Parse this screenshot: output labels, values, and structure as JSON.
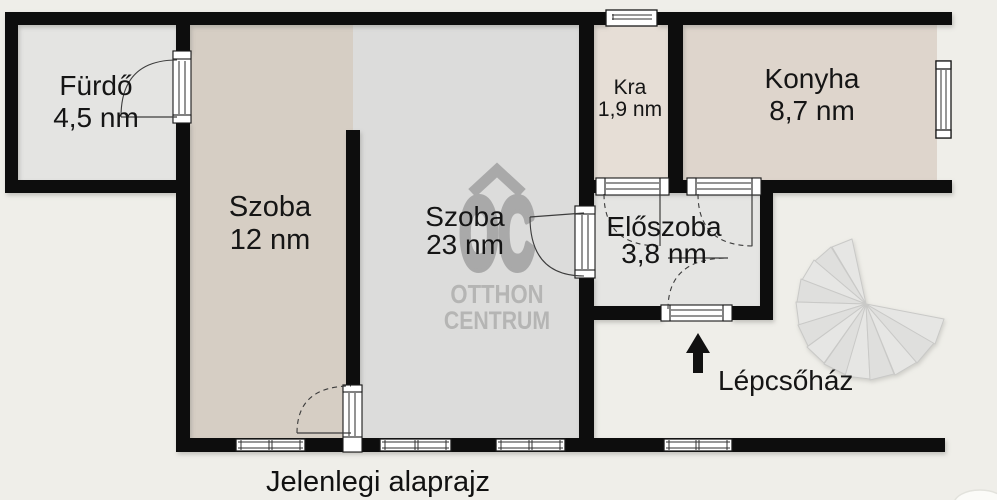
{
  "caption": "Jelenlegi alaprajz",
  "rooms": {
    "furdo": {
      "label": "Fürdő",
      "area": "4,5 nm"
    },
    "szoba12": {
      "label": "Szoba",
      "area": "12 nm"
    },
    "szoba23": {
      "label": "Szoba",
      "area": "23 nm"
    },
    "kra": {
      "label": "Kra",
      "area": "1,9 nm"
    },
    "konyha": {
      "label": "Konyha",
      "area": "8,7 nm"
    },
    "eloszoba": {
      "label": "Előszoba",
      "area": "3,8 nm"
    }
  },
  "annotations": {
    "staircase_label": "Lépcsőház"
  },
  "watermark": {
    "logo": "OC",
    "line1": "OTTHON",
    "line2": "CENTRUM"
  },
  "colors": {
    "background": "#efeee9",
    "wall": "#0c0c0c",
    "furdo_fill": "#e4e4e2",
    "szoba12_fill": "#d6cec4",
    "szoba23_fill": "#dcdcdb",
    "kra_fill": "#e6ded6",
    "konyha_fill": "#ded5cc",
    "eloszoba_fill": "#e5e5e3",
    "stairs_fill": "#e3e3e2",
    "logo_gray": "#a9a9a9"
  }
}
